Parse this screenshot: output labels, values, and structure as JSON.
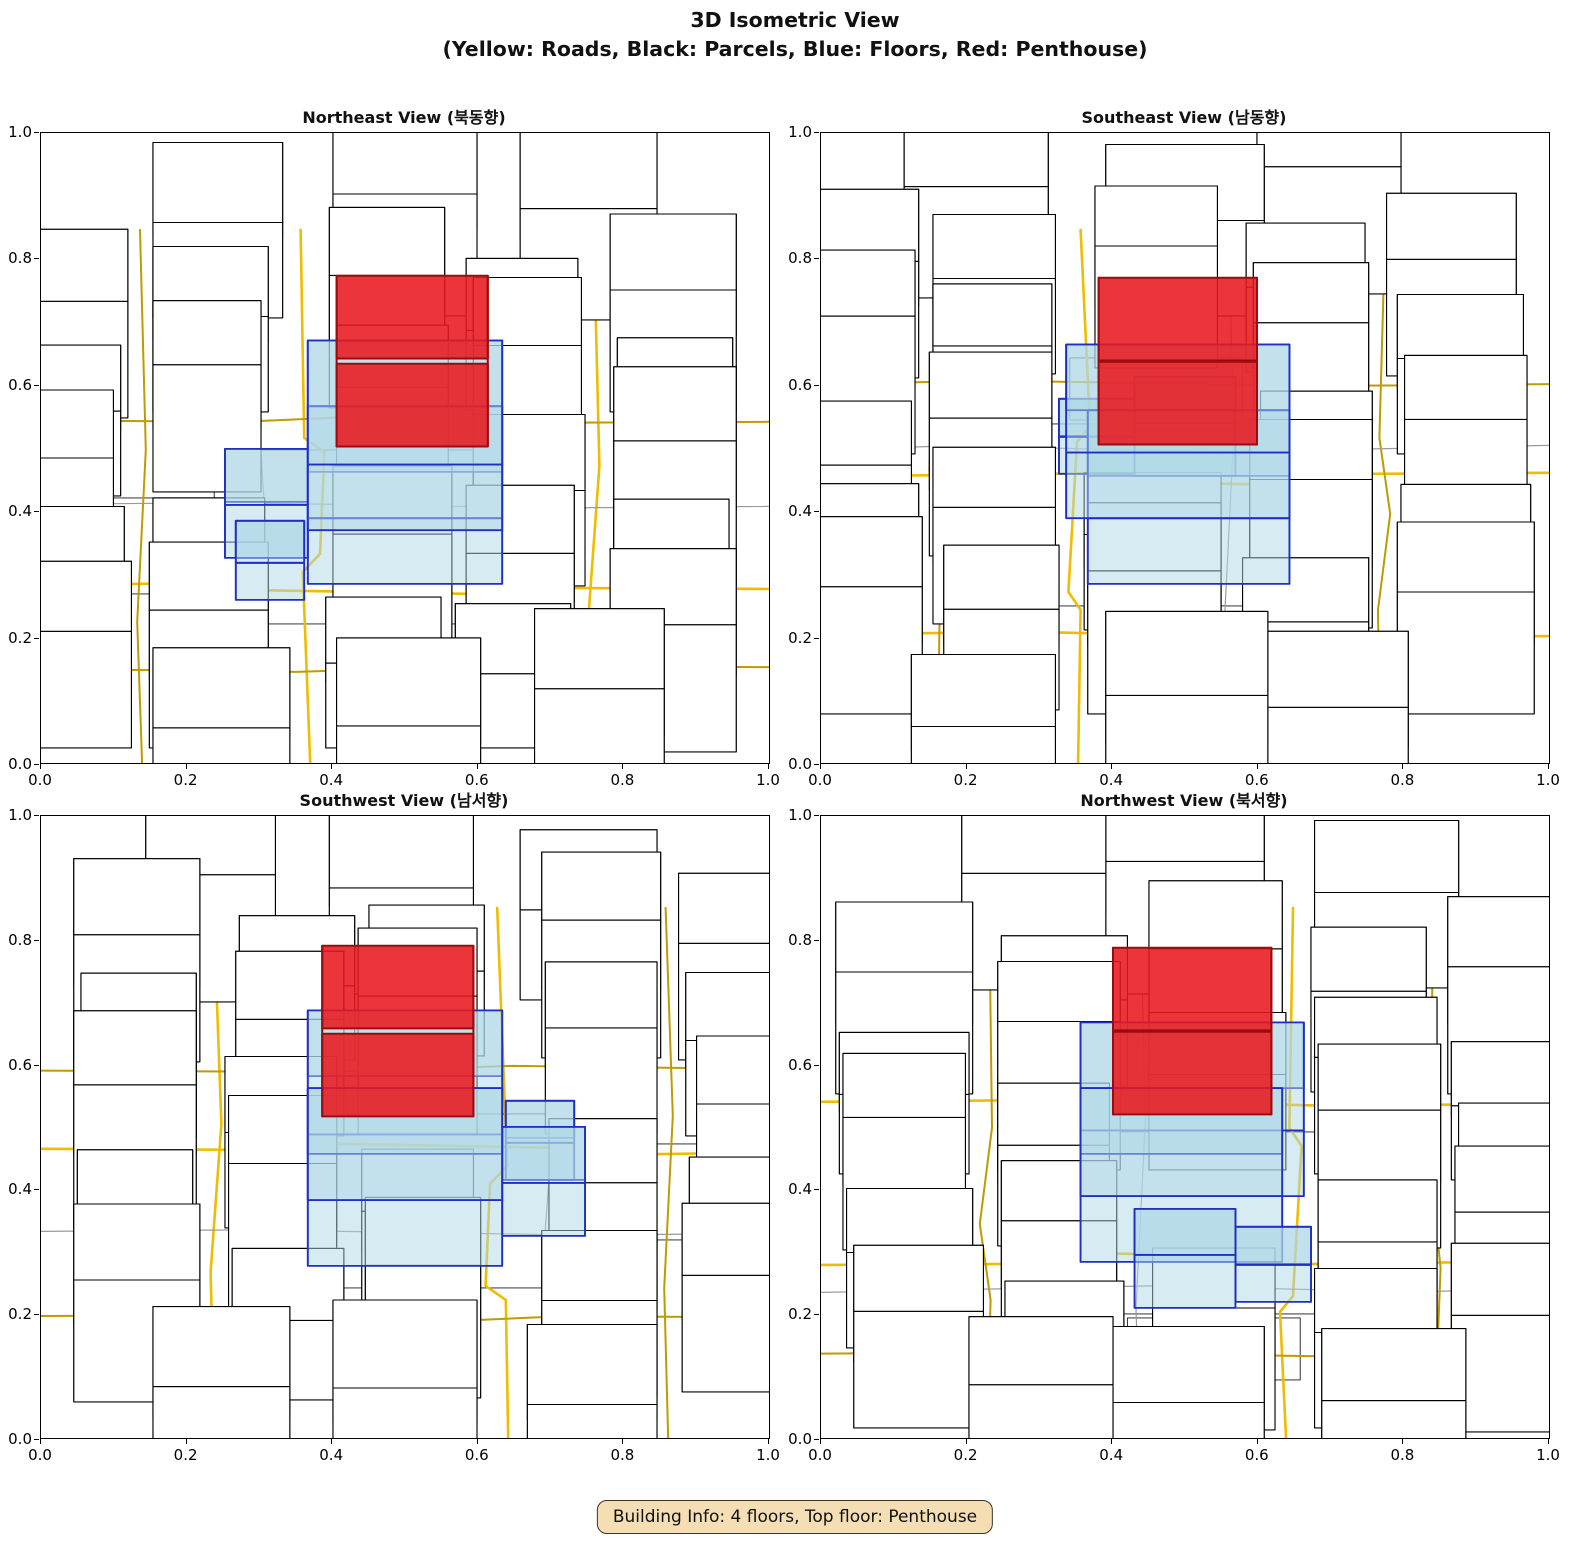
{
  "figure": {
    "title_line1": "3D Isometric View",
    "title_line2": "(Yellow: Roads, Black: Parcels, Blue: Floors, Red: Penthouse)"
  },
  "badge": {
    "text": "Building Info: 4 floors, Top floor: Penthouse"
  },
  "subplots": [
    {
      "title": "Northeast View (북동향)",
      "azimuth": 45
    },
    {
      "title": "Southeast View (남동향)",
      "azimuth": 135
    },
    {
      "title": "Southwest View (남서향)",
      "azimuth": 225
    },
    {
      "title": "Northwest View (북서향)",
      "azimuth": 315
    }
  ],
  "axes": {
    "xticks": [
      "0.0",
      "0.2",
      "0.4",
      "0.6",
      "0.8",
      "1.0"
    ],
    "yticks": [
      "1.0",
      "0.8",
      "0.6",
      "0.4",
      "0.2",
      "0.0"
    ]
  },
  "colors": {
    "background": "#ffffff",
    "road_major": "#eebc00",
    "road_minor": "#bf9a00",
    "road_gray": "#9a9a9a",
    "parcel_edge": "#000000",
    "building_fill": "#ffffff",
    "lot_edge": "#1a1a1a",
    "floor_fill": "#add8e6",
    "floor_edge": "#1f2fc4",
    "penthouse_fill": "#e8191f",
    "penthouse_edge": "#9a0c10",
    "badge_bg": "#f5deb3",
    "badge_border": "#3a332a",
    "badge_text": "#111111"
  },
  "chart_data": {
    "type": "3d-isometric-city-views",
    "title": "3D Isometric View",
    "subtitle": "(Yellow: Roads, Black: Parcels, Blue: Floors, Red: Penthouse)",
    "legend": {
      "Yellow": "Roads",
      "Black": "Parcels",
      "Blue": "Floors",
      "Red": "Penthouse"
    },
    "building_info": {
      "floors": 4,
      "top_floor": "Penthouse"
    },
    "views": [
      {
        "name": "Northeast",
        "korean": "북동향",
        "azimuth_deg": 45
      },
      {
        "name": "Southeast",
        "korean": "남동향",
        "azimuth_deg": 135
      },
      {
        "name": "Southwest",
        "korean": "남서향",
        "azimuth_deg": 225
      },
      {
        "name": "Northwest",
        "korean": "북서향",
        "azimuth_deg": 315
      }
    ],
    "axis_range": {
      "x": [
        0.0,
        1.0
      ],
      "y": [
        0.0,
        1.0
      ],
      "tick_step": 0.2
    },
    "scene": {
      "extent": 7.5,
      "lots": [
        [
          -2.0,
          -1.9,
          4.35,
          4.55
        ],
        [
          -0.8,
          2.75,
          2.4,
          1.55
        ]
      ],
      "buildings": [
        [
          -4.85,
          -4.6,
          1.9,
          1.75,
          1.15
        ],
        [
          -2.55,
          -4.55,
          1.75,
          1.6,
          0.85
        ],
        [
          -0.5,
          -4.6,
          1.85,
          1.7,
          1.35
        ],
        [
          1.75,
          -4.5,
          1.6,
          1.6,
          0.95
        ],
        [
          3.65,
          -4.6,
          1.9,
          1.75,
          1.2
        ],
        [
          -4.8,
          -2.4,
          1.8,
          1.55,
          0.75
        ],
        [
          -2.6,
          -2.45,
          1.7,
          1.5,
          1.4
        ],
        [
          -0.5,
          -2.5,
          1.9,
          1.55,
          0.9
        ],
        [
          1.8,
          -2.35,
          1.7,
          1.5,
          1.1
        ],
        [
          3.7,
          -2.3,
          1.75,
          1.6,
          0.7
        ],
        [
          -4.75,
          -0.55,
          1.7,
          1.6,
          1.25
        ],
        [
          -2.6,
          -0.6,
          1.55,
          1.55,
          0.95
        ],
        [
          1.85,
          -0.65,
          1.7,
          1.65,
          1.3
        ],
        [
          3.8,
          -0.5,
          1.65,
          1.6,
          0.8
        ],
        [
          -4.7,
          1.9,
          1.75,
          1.6,
          0.9
        ],
        [
          -2.55,
          2.0,
          1.6,
          1.5,
          1.2
        ],
        [
          1.85,
          1.95,
          1.65,
          1.55,
          1.0
        ],
        [
          3.75,
          1.9,
          1.7,
          1.65,
          1.3
        ],
        [
          -4.6,
          3.85,
          1.8,
          1.65,
          1.1
        ],
        [
          -2.5,
          3.95,
          1.65,
          1.6,
          0.8
        ],
        [
          -0.45,
          4.05,
          1.7,
          1.5,
          1.15
        ],
        [
          1.8,
          3.9,
          1.7,
          1.6,
          0.9
        ],
        [
          3.7,
          3.8,
          1.75,
          1.8,
          1.1
        ],
        [
          5.35,
          -1.05,
          2.2,
          2.0,
          1.0
        ],
        [
          -7.55,
          -1.0,
          2.2,
          2.0,
          1.15
        ],
        [
          -1.1,
          5.35,
          2.2,
          1.9,
          0.9
        ],
        [
          -1.15,
          -7.45,
          2.25,
          2.1,
          1.25
        ],
        [
          5.2,
          1.6,
          2.0,
          1.9,
          0.85
        ],
        [
          5.15,
          -3.6,
          2.0,
          1.8,
          1.2
        ],
        [
          -7.3,
          1.7,
          2.0,
          1.8,
          0.9
        ],
        [
          -7.25,
          -3.5,
          2.0,
          1.9,
          1.05
        ],
        [
          1.9,
          5.8,
          2.0,
          1.8,
          1.05
        ],
        [
          -3.0,
          5.9,
          2.0,
          1.7,
          1.2
        ],
        [
          1.8,
          -7.3,
          2.0,
          1.8,
          0.9
        ],
        [
          -3.1,
          -7.35,
          2.0,
          1.9,
          1.1
        ]
      ],
      "roads": [
        {
          "c": "major",
          "pts": [
            [
              -7.5,
              1.45
            ],
            [
              -2.3,
              1.4
            ],
            [
              -1.95,
              1.12
            ],
            [
              0.6,
              1.18
            ],
            [
              1.05,
              1.42
            ],
            [
              7.5,
              1.28
            ]
          ]
        },
        {
          "c": "major",
          "pts": [
            [
              1.5,
              -7.5
            ],
            [
              1.45,
              -2.0
            ],
            [
              1.62,
              -1.55
            ],
            [
              1.5,
              2.2
            ],
            [
              1.32,
              2.6
            ],
            [
              1.45,
              7.5
            ]
          ]
        },
        {
          "c": "major",
          "pts": [
            [
              -7.5,
              -2.62
            ],
            [
              -1.6,
              -2.7
            ],
            [
              2.1,
              -2.55
            ],
            [
              7.5,
              -2.66
            ]
          ]
        },
        {
          "c": "minor",
          "pts": [
            [
              -2.72,
              -7.5
            ],
            [
              -2.68,
              -2.0
            ],
            [
              -2.85,
              0.4
            ],
            [
              -2.7,
              2.3
            ],
            [
              -2.78,
              7.5
            ]
          ]
        },
        {
          "c": "minor",
          "pts": [
            [
              -7.5,
              3.68
            ],
            [
              -2.0,
              3.6
            ],
            [
              2.3,
              3.72
            ],
            [
              7.5,
              3.62
            ]
          ]
        },
        {
          "c": "minor",
          "pts": [
            [
              3.45,
              -7.5
            ],
            [
              3.4,
              -1.1
            ],
            [
              3.55,
              1.5
            ],
            [
              3.42,
              7.5
            ]
          ]
        },
        {
          "c": "gray",
          "pts": [
            [
              -7.5,
              2.2
            ],
            [
              -0.5,
              1.95
            ],
            [
              3.2,
              2.1
            ],
            [
              7.5,
              1.9
            ]
          ]
        },
        {
          "c": "gray",
          "pts": [
            [
              -0.62,
              -7.5
            ],
            [
              -0.55,
              -2.2
            ],
            [
              -0.68,
              2.5
            ],
            [
              -0.6,
              7.5
            ]
          ]
        }
      ],
      "target_building": {
        "floors": [
          [
            -1.45,
            -1.35,
            2.8,
            2.7,
            0,
            0.62
          ],
          [
            -1.45,
            -1.35,
            3.1,
            2.7,
            0.62,
            1.24
          ],
          [
            -0.7,
            1.35,
            1.4,
            1.15,
            0,
            0.5
          ],
          [
            0.7,
            1.4,
            1.05,
            0.95,
            0,
            0.35
          ]
        ],
        "penthouse": [
          -1.0,
          -1.15,
          2.2,
          2.1,
          1.24,
          2.02
        ]
      }
    }
  }
}
